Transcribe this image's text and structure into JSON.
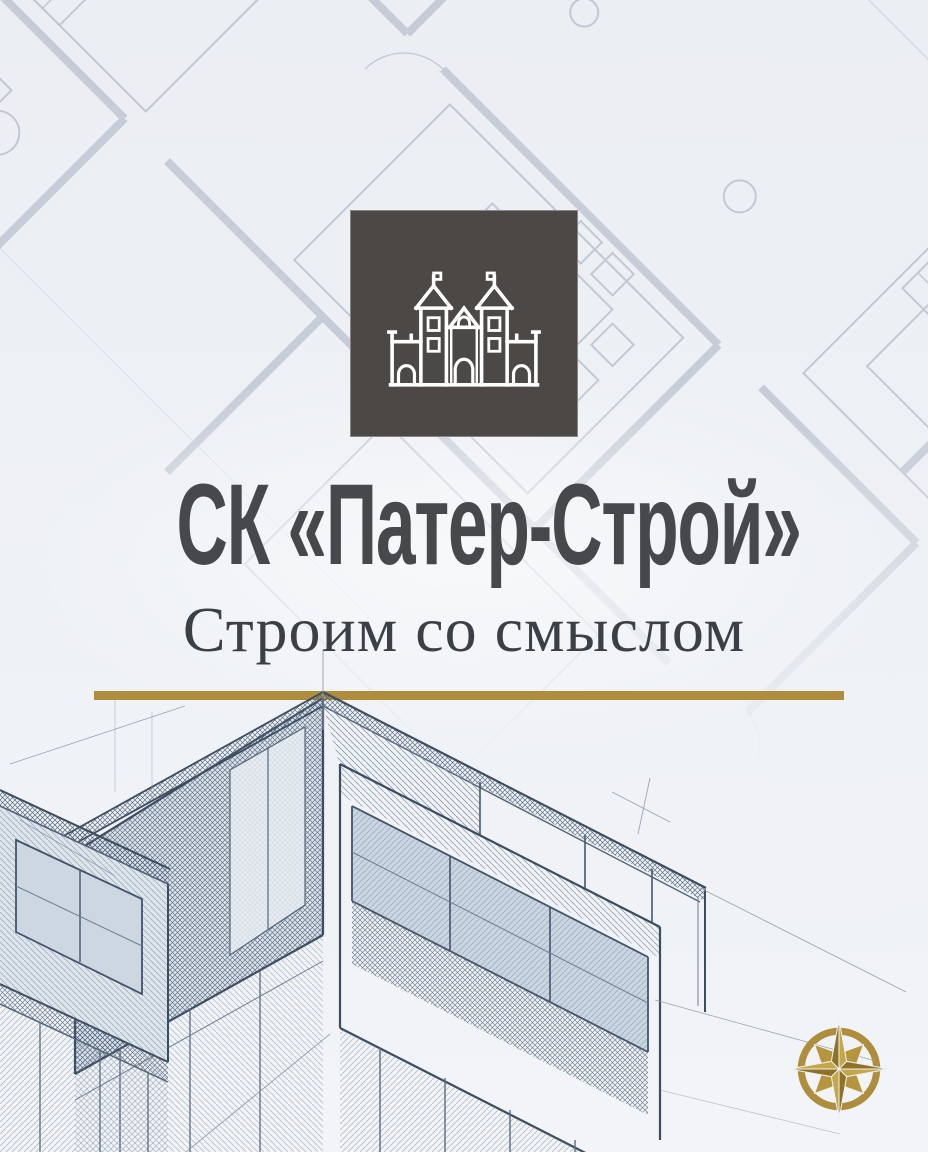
{
  "brand": {
    "name": "СК «Патер-Строй»",
    "tagline": "Строим со смыслом"
  },
  "logo": {
    "symbol": "castle-line-art",
    "description": "white outlined castle with two spired towers on dark square"
  },
  "decor": {
    "compass_icon": "gold eight-point compass rose",
    "background_motif": "architectural floor plan blueprint rotated 45 degrees",
    "foreground_motif": "pencil sketch of modern cantilevered house"
  },
  "colors": {
    "page-bg": "#eef1f5",
    "logo-bg": "#4b4846",
    "title-ink": "#46484b",
    "subtitle-ink": "#3a4046",
    "accent-gold": "#ae8d3c",
    "sketch-ink": "#3d4d60",
    "plan-ink": "#9aa5b6"
  }
}
